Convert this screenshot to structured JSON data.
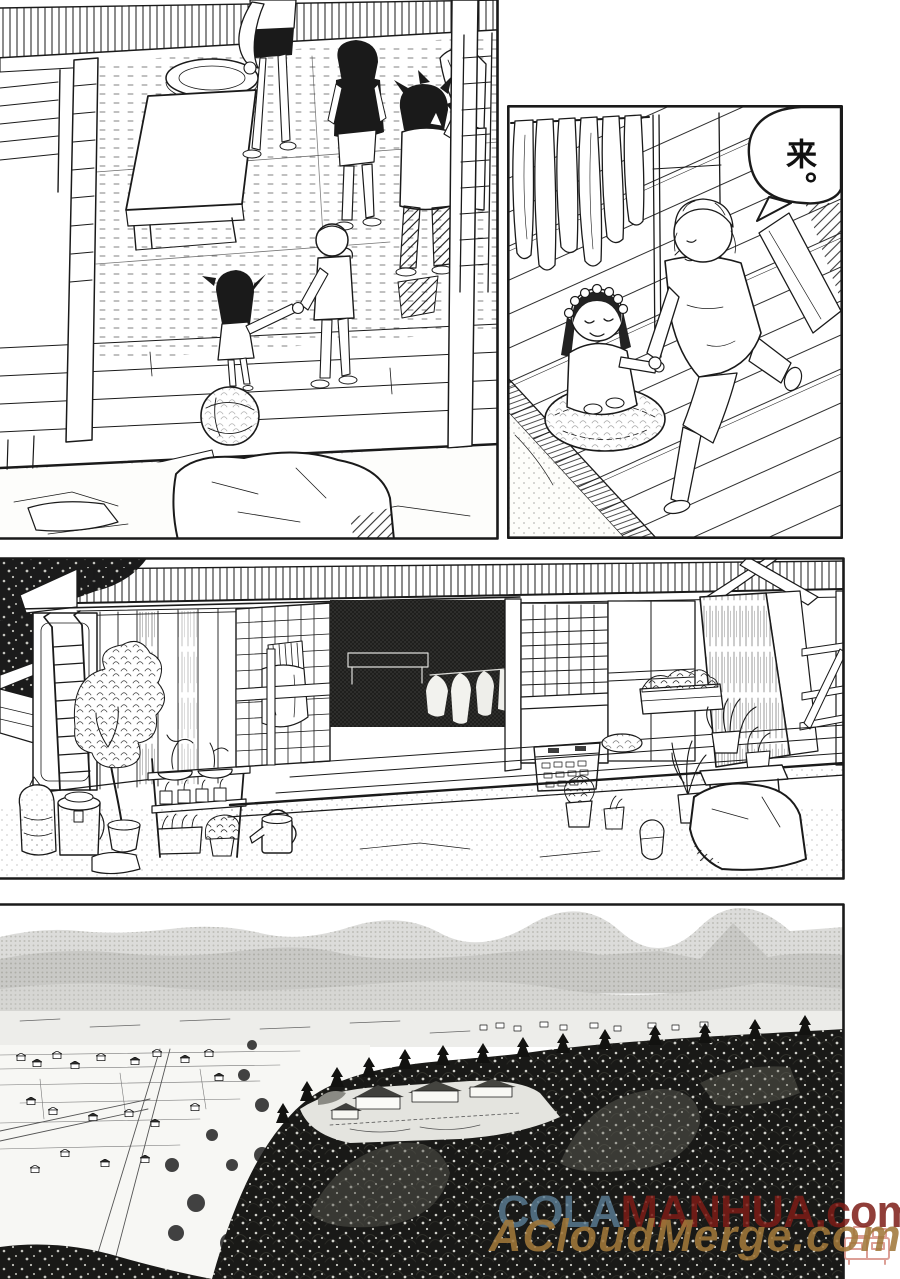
{
  "page": {
    "medium": "manga page scan",
    "background": "#ffffff",
    "ink": "#1a1a1a",
    "tone_grey": "#c7c7c5"
  },
  "panels": [
    {
      "id": "panel-1",
      "scene": "Interior room seen from above: person in dark tee and person in white shirt by a ladder, low table and round tray, two small children walking hand in hand onto the veranda past a woven straw ball, large rock in the garden below"
    },
    {
      "id": "panel-2",
      "bubble_text": "来。",
      "scene": "A girl wearing a flower wreath sits smiling on a round straw cushion while an older light-haired child kneels on the plank deck and takes her hand; cloths hang from a pole at the left"
    },
    {
      "id": "panel-3",
      "scene": "Front of an old house: corrugated roof, ladder against wood siding, potted tree and plant shelf, lattice door with hanging cloth, dark open doorway with laundry inside, shoji window, laundry basket, watering can, plant bench and rocks by the veranda"
    },
    {
      "id": "panel-4",
      "scene": "Bird's-eye landscape: town with fields and roads at left, dense forest with a temple compound clearing at right, layered mountain ridges in the distance"
    }
  ],
  "watermarks": {
    "line1": {
      "part1": "COLA",
      "part1_color": "#5a7d94",
      "part2": "MANHUA.com",
      "part2_color": "#7d1c16"
    },
    "line2": {
      "text": "ACloudMerge.com",
      "color": "#a0783a"
    },
    "logo_color": "#d9958b"
  }
}
